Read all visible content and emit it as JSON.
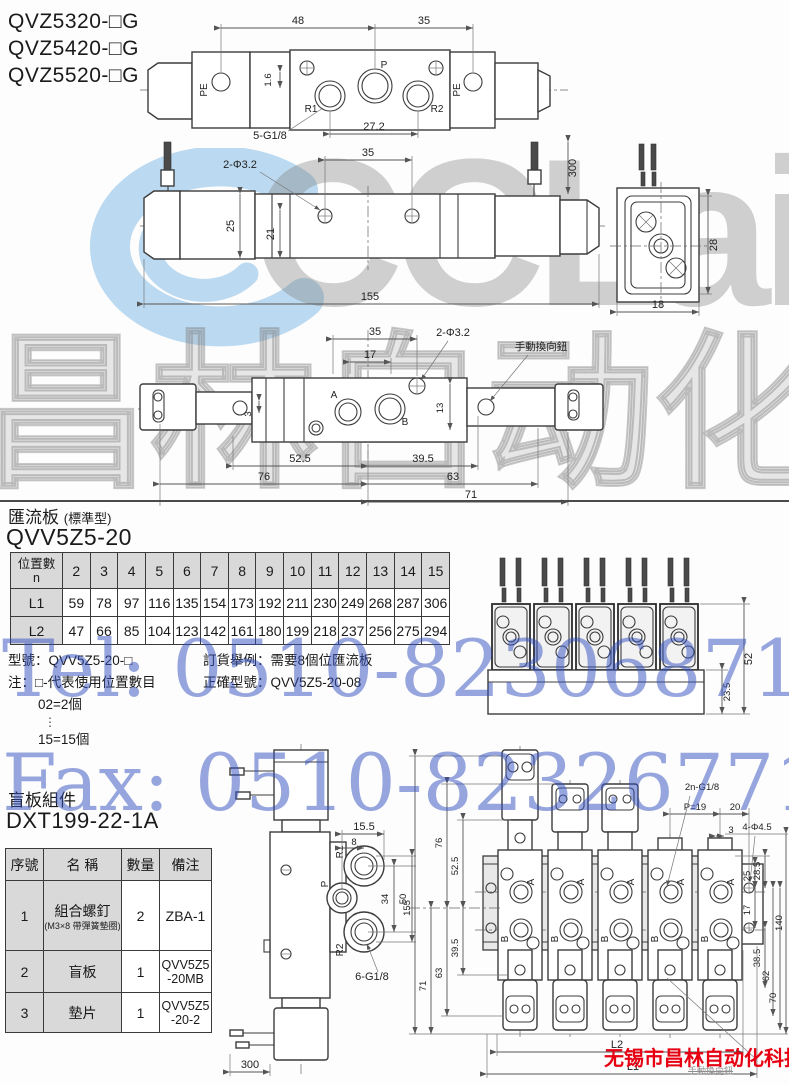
{
  "watermark": {
    "logo_text": "CCLair",
    "brand_cn": "昌林自动化",
    "tel": "Tel: 0510-82306871",
    "fax": "Fax: 0510-82326771",
    "company_red": "无锡市昌林自动化科技",
    "manual_small": "手動換向鈕",
    "blue": "#2f4dbe",
    "red": "#e60012",
    "logo_blue": "#aacfec",
    "gray": "#8c8c8c"
  },
  "models": [
    "QVZ5320-□G",
    "QVZ5420-□G",
    "QVZ5520-□G"
  ],
  "sections": {
    "manifold_title": "匯流板",
    "manifold_title_sub": "(標準型)",
    "manifold_model": "QVV5Z5-20",
    "blind_title": "盲板組件",
    "blind_model": "DXT199-22-1A"
  },
  "manifold_table": {
    "pos_label": "位置數",
    "pos_sub": "n",
    "cols": [
      "2",
      "3",
      "4",
      "5",
      "6",
      "7",
      "8",
      "9",
      "10",
      "11",
      "12",
      "13",
      "14",
      "15"
    ],
    "l1_label": "L1",
    "l1": [
      "59",
      "78",
      "97",
      "116",
      "135",
      "154",
      "173",
      "192",
      "211",
      "230",
      "249",
      "268",
      "287",
      "306"
    ],
    "l2_label": "L2",
    "l2": [
      "47",
      "66",
      "85",
      "104",
      "123",
      "142",
      "161",
      "180",
      "199",
      "218",
      "237",
      "256",
      "275",
      "294"
    ]
  },
  "notes": {
    "model_line": "型號：QVV5Z5-20-□",
    "note_line": "注：□-代表使用位置數目",
    "eg_first": "02=2個",
    "dots": "⋮",
    "eg_last": "15=15個",
    "order_line1": "訂貨舉例：需要8個位匯流板",
    "order_line2": "正確型號：QVV5Z5-20-08"
  },
  "parts_table": {
    "headers": [
      "序號",
      "名 稱",
      "數量",
      "備注"
    ],
    "rows": [
      {
        "no": "1",
        "name": "組合螺釘",
        "name_sub": "(M3×8 帶彈簧墊圈)",
        "qty": "2",
        "note": "ZBA-1",
        "note2": ""
      },
      {
        "no": "2",
        "name": "盲板",
        "name_sub": "",
        "qty": "1",
        "note": "QVV5Z5",
        "note2": "-20MB"
      },
      {
        "no": "3",
        "name": "墊片",
        "name_sub": "",
        "qty": "1",
        "note": "QVV5Z5",
        "note2": "-20-2"
      }
    ]
  },
  "d1": {
    "dim48": "48",
    "dim35": "35",
    "pe_l": "PE",
    "pe_r": "PE",
    "r1": "R1",
    "p": "P",
    "r2": "R2",
    "dim16": "1.6",
    "thread": "5-G1/8",
    "dim272": "27.2"
  },
  "d2": {
    "holes": "2-Φ3.2",
    "dim35": "35",
    "dim300": "300",
    "dim25": "25",
    "dim21": "21",
    "dim155": "155",
    "dim28": "28",
    "dim18": "18"
  },
  "d3": {
    "dim35": "35",
    "dim17": "17",
    "holes": "2-Φ3.2",
    "manual": "手動換向鈕",
    "a": "A",
    "b": "B",
    "dim3": "3",
    "dim13": "13",
    "dim525": "52.5",
    "dim395": "39.5",
    "dim76": "76",
    "dim63": "63",
    "dim71": "71"
  },
  "mf": {
    "dim52": "52",
    "dim235": "23.5"
  },
  "d4": {
    "dim155": "15.5",
    "dim8": "8",
    "r1": "R1",
    "p": "P",
    "r2": "R2",
    "dim34": "34",
    "dim50": "50",
    "thread": "6-G1/8",
    "dim300": "300"
  },
  "d5": {
    "thread": "2n-G1/8",
    "p19": "P=19",
    "dim20": "20",
    "dim3": "3",
    "holes": "4-Φ4.5",
    "dim76": "76",
    "dim525": "52.5",
    "dim395": "39.5",
    "dim63": "63",
    "dim71": "71",
    "dim155": "155",
    "dim25": "25",
    "dim285": "28.5",
    "dim17": "17",
    "dim385": "38.5",
    "dim62": "62",
    "dim70": "70",
    "dim140": "140",
    "l2": "L2",
    "l1": "L1",
    "a": "A",
    "b": "B"
  }
}
